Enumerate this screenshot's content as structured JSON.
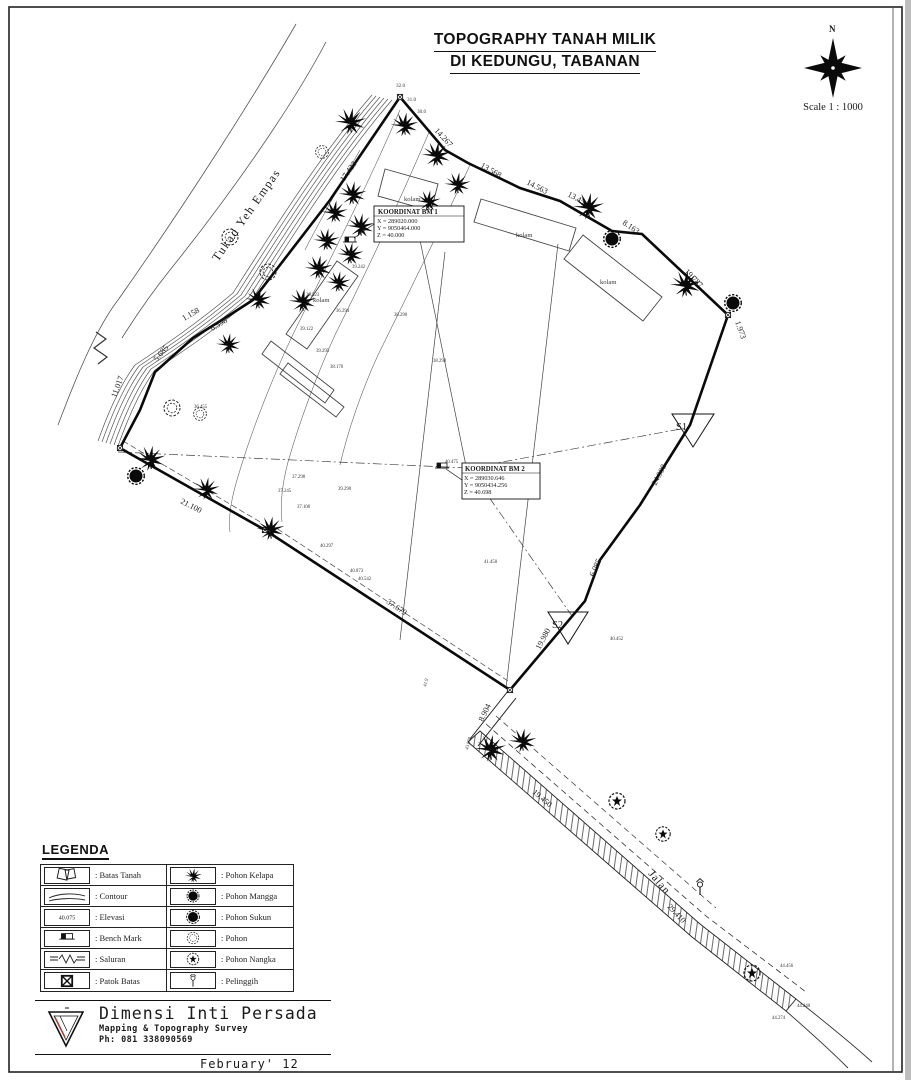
{
  "colors": {
    "ink": "#1a1a1a",
    "paper": "#ffffff",
    "logo_accent": "#c0392b"
  },
  "header": {
    "title_line1": "TOPOGRAPHY TANAH MILIK",
    "title_line2": "DI KEDUNGU, TABANAN",
    "compass_north": "N",
    "scale_label": "Scale 1 : 1000"
  },
  "map": {
    "river_name": "Tukad Yeh Empas",
    "road_label": "Jalan",
    "pond_labels": [
      "kolam",
      "kolam",
      "kolam",
      "kolam"
    ],
    "station_1": "S1",
    "station_2": "S2",
    "contour_labels": [
      "32.0",
      "31.0",
      "30.0"
    ],
    "bm1": {
      "title": "KOORDINAT BM 1",
      "x": "X = 289020.000",
      "y": "Y = 9050464.000",
      "z": "Z = 40.000"
    },
    "bm2": {
      "title": "KOORDINAT BM 2",
      "x": "X = 289030.646",
      "y": "Y = 9050434.256",
      "z": "Z = 40.698"
    },
    "dimensions": [
      "17.423",
      "14.267",
      "13.568",
      "14.563",
      "13.454",
      "8.163",
      "19.787",
      "1.973",
      "24.998",
      "6.085",
      "19.980",
      "8.904",
      "19.450",
      "29.410",
      "37.679",
      "21.100",
      "11.017",
      "5.685",
      "1.158",
      "6.598"
    ],
    "elevations": [
      "39.242",
      "39.122",
      "39.295",
      "38.170",
      "36.455",
      "39.523",
      "36.294",
      "38.290",
      "37.298",
      "37.245",
      "37.106",
      "39.290",
      "40.297",
      "40.873",
      "40.542",
      "41.450",
      "40.452",
      "43.000",
      "41.9",
      "44.456",
      "44.240",
      "44.274",
      "40.475",
      "38.298"
    ]
  },
  "legend": {
    "heading": "LEGENDA",
    "elevation_value": "40.075",
    "items_left": [
      ": Batas Tanah",
      ": Contour",
      ": Elevasi",
      ": Bench Mark",
      ": Saluran",
      ": Patok Batas"
    ],
    "items_right": [
      ": Pohon Kelapa",
      ": Pohon Mangga",
      ": Pohon Sukun",
      ": Pohon",
      ": Pohon Nangka",
      ": Pelinggih"
    ]
  },
  "footer": {
    "company": "Dimensi Inti Persada",
    "tagline": "Mapping & Topography Survey",
    "phone": "Ph: 081 338090569",
    "date": "February' 12"
  }
}
